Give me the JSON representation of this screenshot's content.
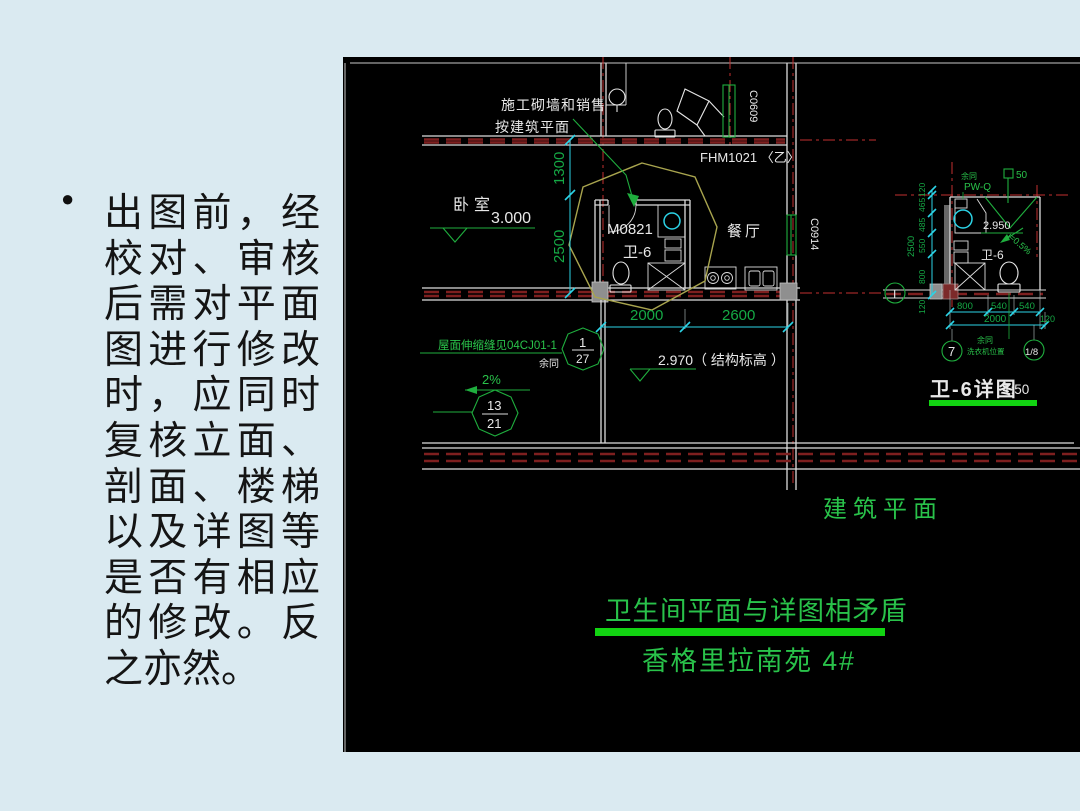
{
  "slide": {
    "bullet": "●",
    "body_lines": [
      "出图前，经",
      "校对、审核",
      "后需对平面",
      "图进行修改",
      "时，应同时",
      "复核立面、",
      "剖面、楼梯",
      "以及详图等",
      "是否有相应",
      "的修改。反",
      "之亦然。"
    ]
  },
  "cad": {
    "colors": {
      "slide_background": "#daeaf1",
      "canvas": "#000000",
      "annotation_green": "#29c24a",
      "highlight_green": "#12d412",
      "dimension_cyan": "#2cd3e6",
      "centerline_red": "#c23030",
      "wall_fill_red": "#7e1f1f",
      "linework_white": "#dcdcdc",
      "revision_cloud_yellow": "#a8a44e"
    },
    "plan": {
      "note_leader_1": "施工砌墙和销售",
      "note_leader_2": "按建筑平面",
      "door_top": "FHM1021 〈乙〉",
      "window_top": "C0609",
      "window_right": "C0914",
      "bedroom": "卧室",
      "bedroom_level": "3.000",
      "dim_v1": "1300",
      "dim_v2": "2500",
      "bath_door": "M0821",
      "bath_name": "卫-6",
      "dining": "餐厅",
      "dim_h1": "2000",
      "dim_h2": "2600",
      "note_expansion": "屋面伸缩缝见04CJ01-1",
      "note_rest_same": "余同",
      "callout1_num": "1",
      "callout1_den": "27",
      "slope": "2%",
      "callout2_num": "13",
      "callout2_den": "21",
      "level_note": "2.970（ 结构标高 ）"
    },
    "detail": {
      "note_rest_same": "余同",
      "pipe_tag": "PW-Q",
      "pipe_size": "50",
      "level": "2.950",
      "slope": "i=0.5%",
      "room": "卫-6",
      "dims_left": [
        "120",
        "465",
        "485",
        "550",
        "800"
      ],
      "dim_left_total": "2500",
      "dim_left_extra": "120",
      "grid_t": "T",
      "grid_7": "7",
      "grid_1_8": "1/8",
      "dims_bottom": [
        "800",
        "540",
        "540"
      ],
      "dim_bottom_total": "2000",
      "dim_bottom_extra": "120",
      "note_b1": "余同",
      "note_b2": "洗衣机位置",
      "title": "卫-6详图",
      "scale": "1:50"
    },
    "captions": {
      "plan": "建筑平面",
      "issue": "卫生间平面与详图相矛盾",
      "project": "香格里拉南苑 4#"
    }
  }
}
